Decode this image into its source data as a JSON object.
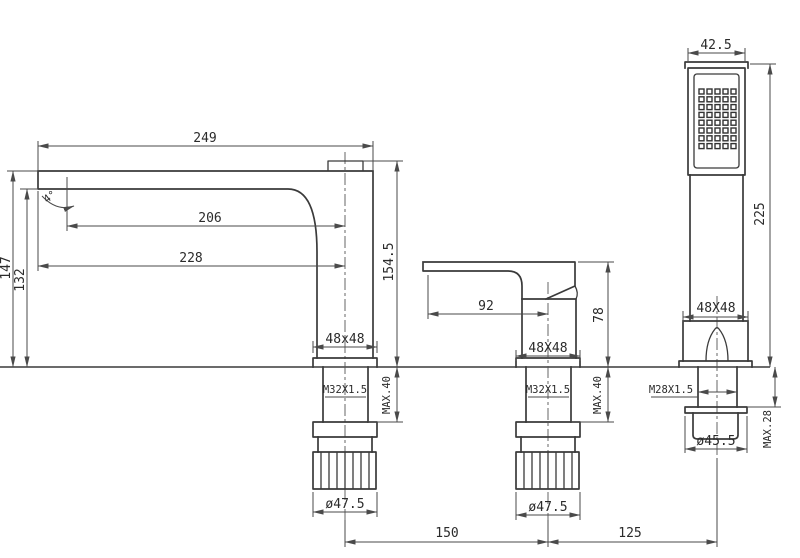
{
  "spout": {
    "reach": "249",
    "reach_mid": "206",
    "reach_low": "228",
    "angle": "4°",
    "height_outer": "147",
    "height_inner": "132",
    "height_total": "154.5",
    "section": "48x48",
    "thread": "M32X1.5",
    "max_deck": "MAX.40",
    "nut_dia": "ø47.5"
  },
  "handle": {
    "lever_length": "92",
    "height": "78",
    "section": "48X48",
    "thread": "M32X1.5",
    "max_deck": "MAX.40",
    "nut_dia": "ø47.5"
  },
  "shower": {
    "head_width": "42.5",
    "height": "225",
    "section": "48X48",
    "thread": "M28X1.5",
    "max_deck": "MAX.28",
    "nut_dia": "ø45.5",
    "nozzle_rows": 8,
    "nozzle_cols": 5
  },
  "spacing": {
    "spout_to_handle": "150",
    "handle_to_shower": "125"
  },
  "colors": {
    "object_line": "#3a3a3a",
    "dimension_line": "#4a4a4a",
    "text": "#2b2b2b",
    "background": "#ffffff"
  }
}
